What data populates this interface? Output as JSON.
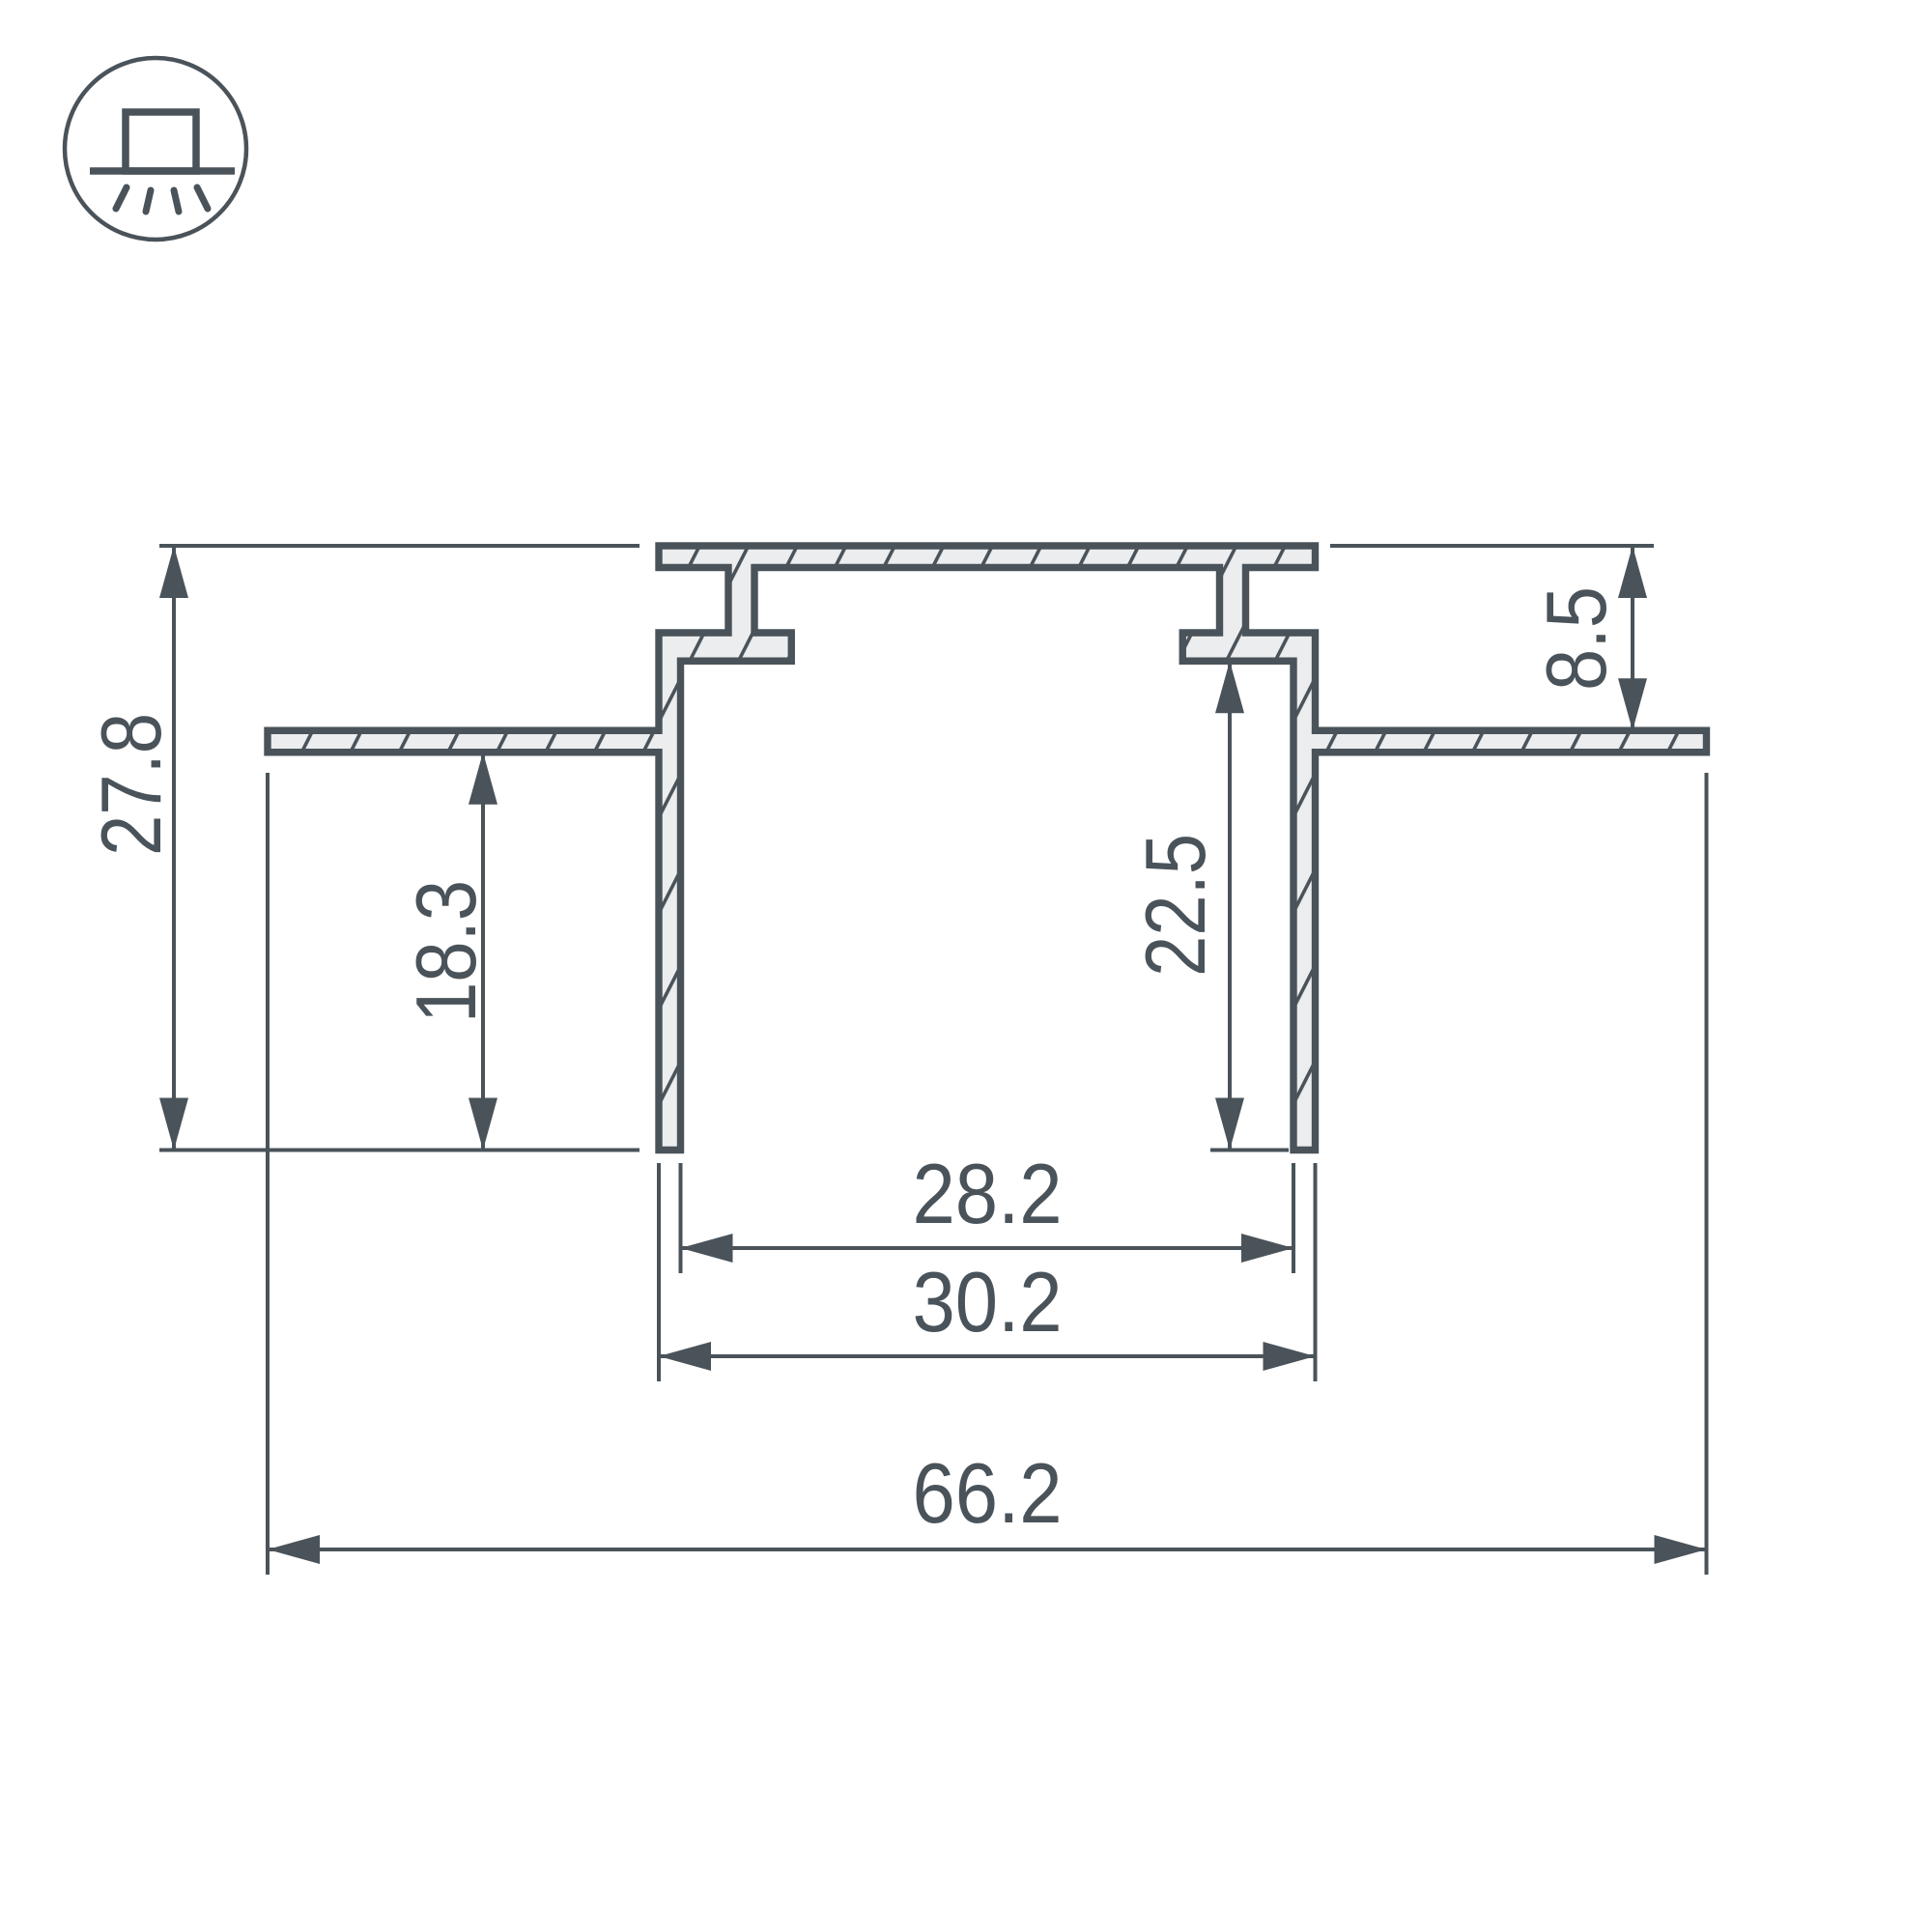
{
  "title": "Recessed LED profile cross-section drawing",
  "icon": {
    "meaning": "recessed-ceiling-mount-luminaire-symbol"
  },
  "dims": {
    "overall_height": "27.8",
    "height_below_flange": "18.3",
    "recess_height": "8.5",
    "inner_depth": "22.5",
    "inner_width": "28.2",
    "outer_width": "30.2",
    "overall_width": "66.2"
  },
  "colors": {
    "line": "#4a535a",
    "metal_fill": "#ecedee",
    "background": "#ffffff"
  }
}
